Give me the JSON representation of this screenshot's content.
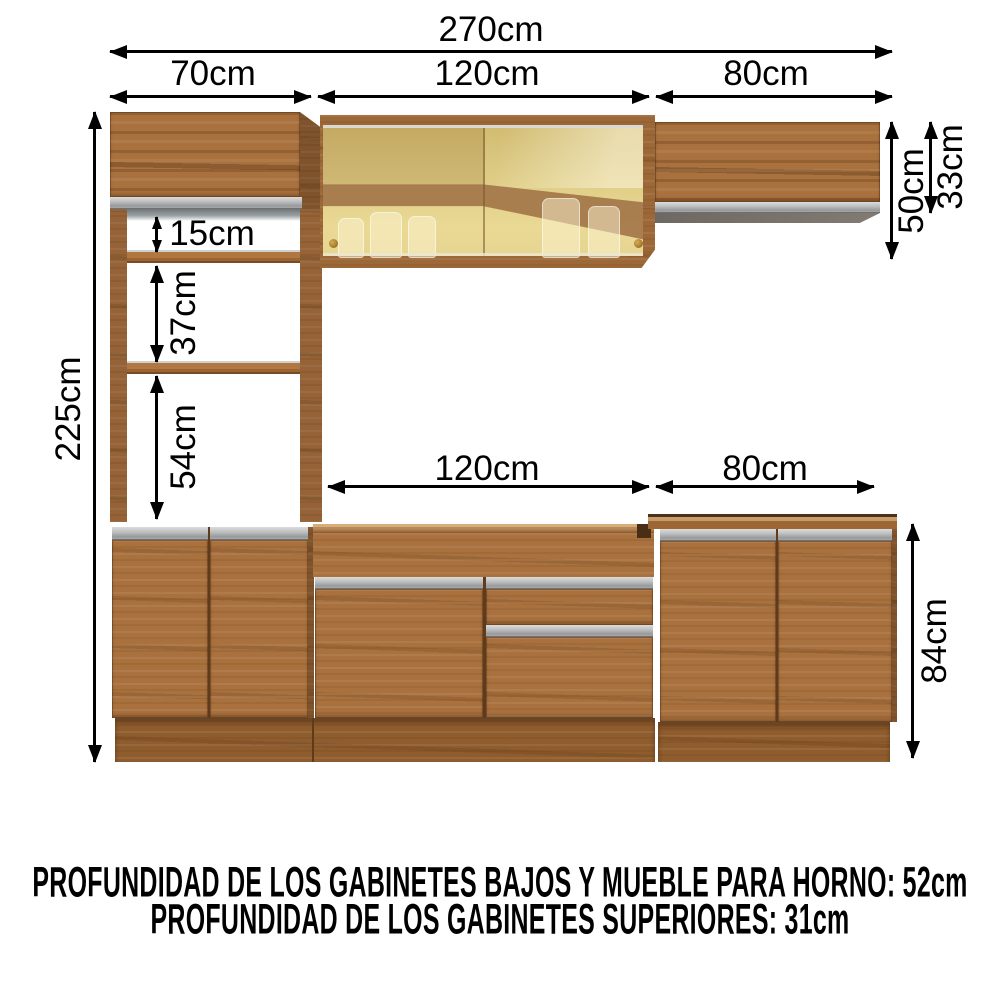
{
  "diagram": {
    "type": "kitchen-cabinet-dimension-diagram",
    "dims": {
      "total_width": "270cm",
      "upper_left": "70cm",
      "upper_center": "120cm",
      "upper_right": "80cm",
      "total_height": "225cm",
      "gap_top": "15cm",
      "gap_middle": "37cm",
      "gap_oven": "54cm",
      "right_total": "50cm",
      "right_door": "33cm",
      "base_center": "120cm",
      "base_right": "80cm",
      "base_height": "84cm"
    },
    "footer": {
      "line1": "PROFUNDIDAD DE LOS GABINETES BAJOS Y MUEBLE PARA HORNO: 52cm",
      "line2": "PROFUNDIDAD DE LOS GABINETES SUPERIORES: 31cm"
    },
    "colors": {
      "background": "#ffffff",
      "annotation": "#000000",
      "wood": "#a9713e",
      "wood_dark": "#7c5126",
      "wood_light": "#c59a64",
      "handle_grey": "#97999a",
      "glass_amber": "#d9c67f",
      "glass_shelf_band": "#a3764a",
      "knob_gold": "#a97f2e"
    }
  }
}
